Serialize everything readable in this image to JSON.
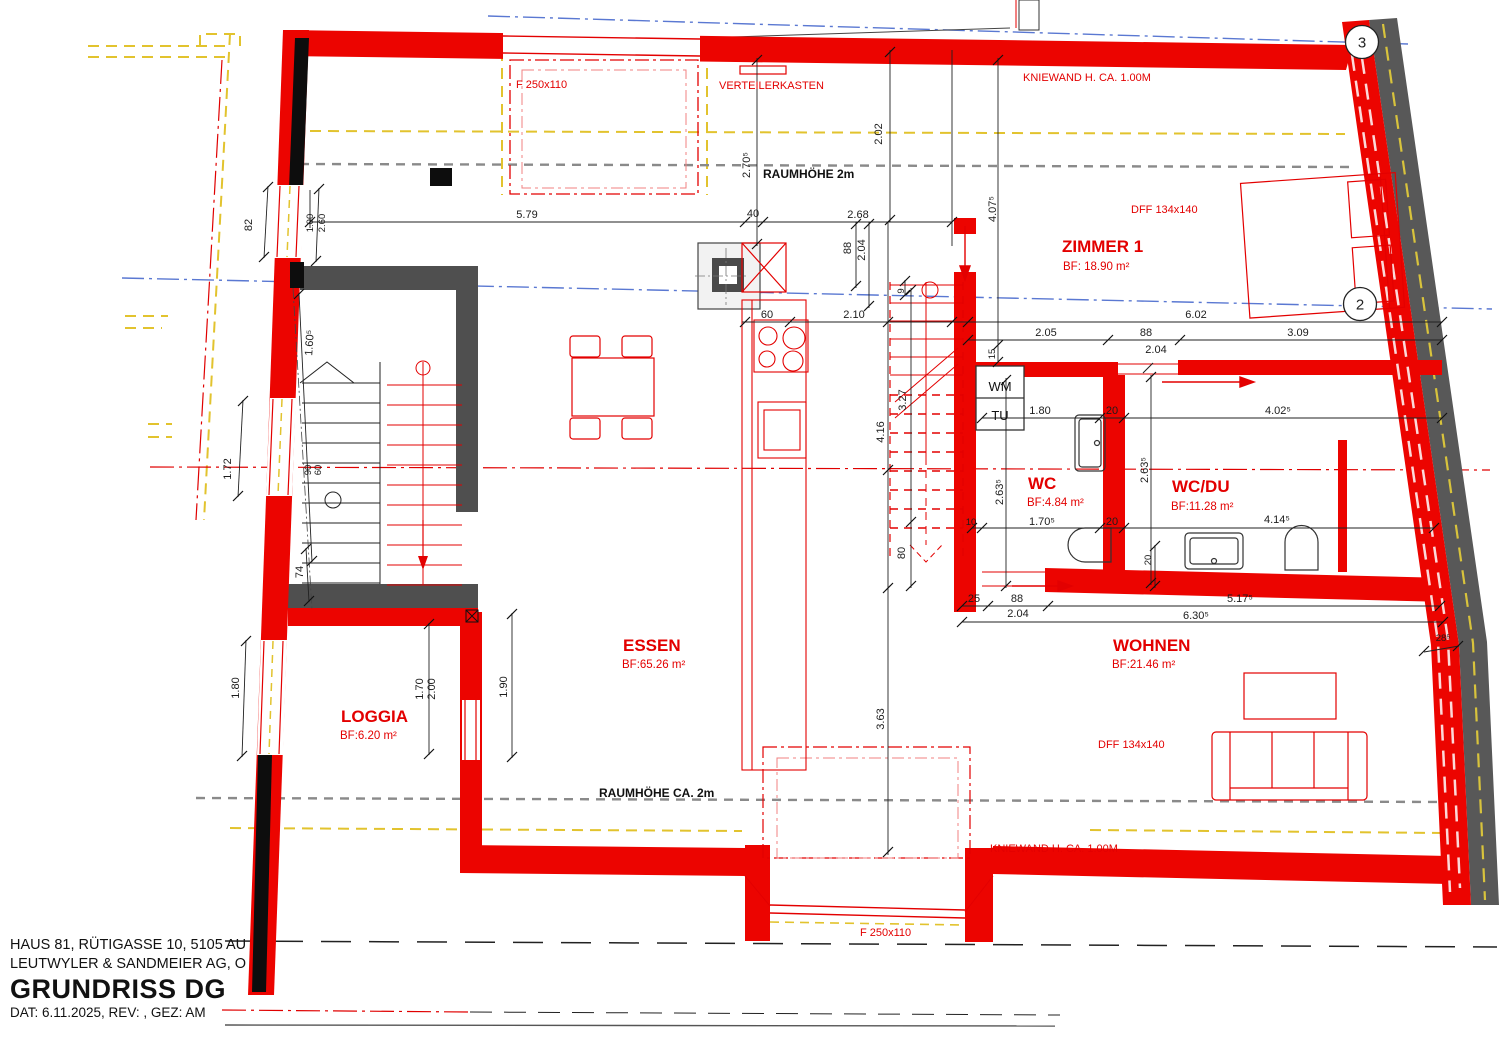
{
  "title_block": {
    "line1": "HAUS 81, RÜTIGASSE 10, 5105 AU",
    "line2": "LEUTWYLER & SANDMEIER AG, O",
    "title": "GRUNDRISS DG",
    "date_line": "DAT: 6.11.2025, REV: , GEZ: AM"
  },
  "rooms": [
    {
      "name": "ZIMMER 1",
      "area": "BF: 18.90 m²"
    },
    {
      "name": "WC",
      "area": "BF:4.84 m²"
    },
    {
      "name": "WC/DU",
      "area": "BF:11.28 m²"
    },
    {
      "name": "ESSEN",
      "area": "BF:65.26 m²"
    },
    {
      "name": "WOHNEN",
      "area": "BF:21.46 m²"
    },
    {
      "name": "LOGGIA",
      "area": "BF:6.20 m²"
    }
  ],
  "annotations": {
    "window_top": "F 250x110",
    "verteilerkasten": "VERTEILERKASTEN",
    "kniewand_top": "KNIEWAND H. CA. 1.00M",
    "dff_top": "DFF 134x140",
    "raumhoehe_top": "RAUMHÖHE 2m",
    "wm": "WM",
    "tu": "TU",
    "raumhoehe_bottom": "RAUMHÖHE CA. 2m",
    "kniewand_bottom": "KNIEWAND H. CA. 1.00M",
    "window_bottom": "F 250x110",
    "dff_bottom": "DFF 134x140"
  },
  "markers": {
    "axis3": "3",
    "axis2": "2"
  },
  "dims": [
    "5.79",
    "40",
    "2.68",
    "2.02",
    "2.70⁵",
    "88",
    "2.04",
    "60",
    "2.10",
    "9",
    "6.02",
    "2.05",
    "88",
    "3.09",
    "2.04",
    "4.07⁵",
    "15",
    "1.80",
    "20",
    "4.02⁵",
    "4.16",
    "3.27",
    "80",
    "2.63⁵",
    "2.63⁵",
    "10",
    "1.70⁵",
    "20",
    "4.14⁵",
    "20",
    "25",
    "88",
    "2.04",
    "5.17⁵",
    "6.30⁵",
    "3.63",
    "28⁵",
    "82",
    "1.00",
    "2.60",
    "1.60⁵",
    "1.72",
    "90",
    "60",
    "74",
    "1.80",
    "1.70",
    "2.00",
    "1.90"
  ],
  "colors": {
    "wall_red": "#ec0400",
    "wall_gray": "#4f4f4f",
    "existing_yellow": "#e2c32e",
    "axis_blue": "#5a78d2",
    "axis_red": "#e00000",
    "dash_gray": "#8a8a8a"
  }
}
